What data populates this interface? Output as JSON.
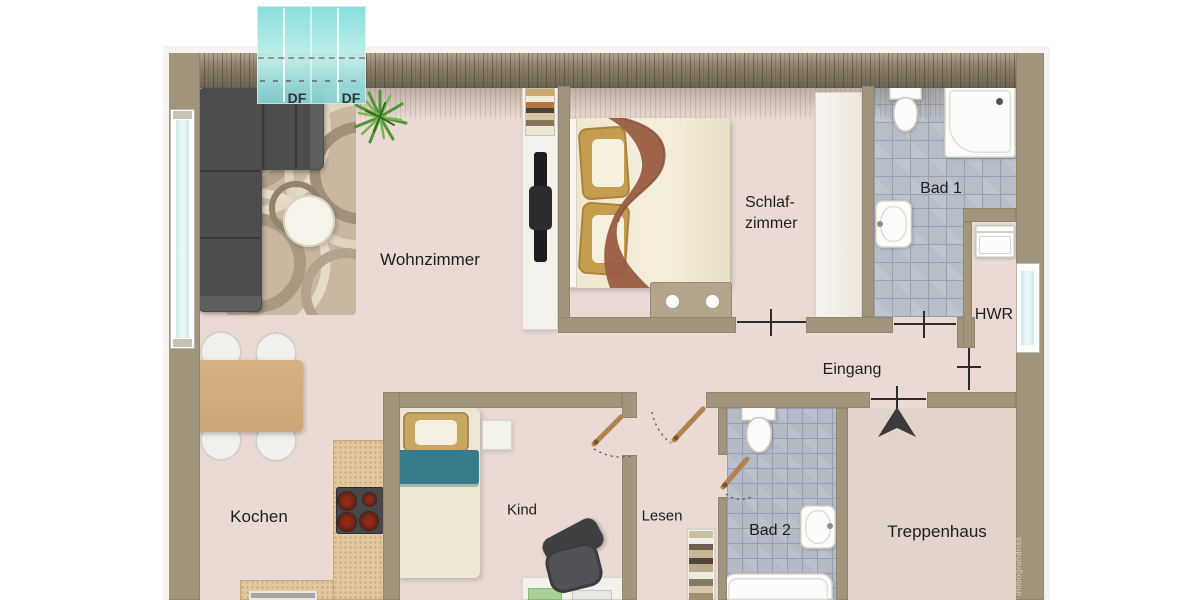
{
  "plan_type": "apartment floor plan",
  "rooms": [
    {
      "id": "wohnzimmer",
      "label": "Wohnzimmer"
    },
    {
      "id": "schlafzimmer",
      "label": "Schlaf-zimmer",
      "line1": "Schlaf-",
      "line2": "zimmer"
    },
    {
      "id": "bad-1",
      "label": "Bad 1"
    },
    {
      "id": "hwr",
      "label": "HWR"
    },
    {
      "id": "eingang",
      "label": "Eingang"
    },
    {
      "id": "kochen",
      "label": "Kochen"
    },
    {
      "id": "kind",
      "label": "Kind"
    },
    {
      "id": "lesen",
      "label": "Lesen"
    },
    {
      "id": "bad-2",
      "label": "Bad 2"
    },
    {
      "id": "treppenhaus",
      "label": "Treppenhaus"
    }
  ],
  "skylights": {
    "left": "DF",
    "right": "DF"
  },
  "watermark": "Immogrundriss",
  "colors": {
    "wall": "#a1957e",
    "top_wall": "#7c7160",
    "floor": "#ebdad4",
    "bathroom_tile": "#b7bec9",
    "skylight": "#8fdfde",
    "door_leaf": "#b28350",
    "sofa": "#4c4c4f",
    "accent_teal_bed": "#357d8d",
    "wood_table": "#d2aa7d"
  }
}
